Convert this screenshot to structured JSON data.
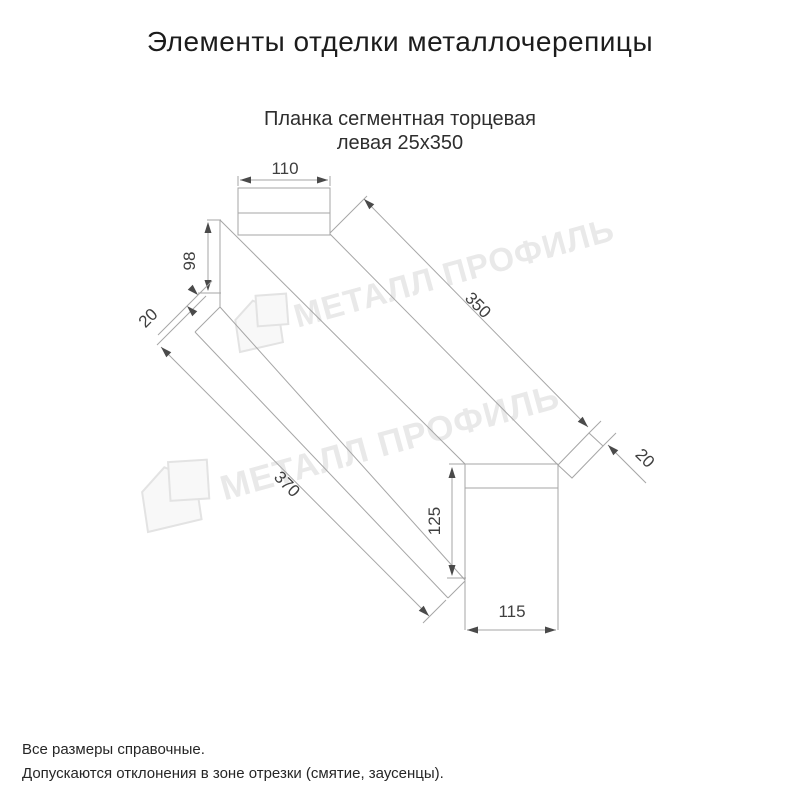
{
  "title": "Элементы отделки металлочерепицы",
  "product": {
    "line1": "Планка сегментная торцевая",
    "line2": "левая 25х350"
  },
  "dimensions": {
    "top_width": "110",
    "left_height": "98",
    "left_flap": "20",
    "top_length": "350",
    "right_flap": "20",
    "right_height": "125",
    "bottom_width": "115",
    "bottom_length": "370"
  },
  "watermark": {
    "brand": "МЕТАЛЛ ПРОФИЛЬ"
  },
  "notes": {
    "line1": "Все размеры справочные.",
    "line2": "Допускаются отклонения в зоне отрезки (смятие, заусенцы)."
  },
  "colors": {
    "line": "#a6a6a6",
    "dim_text": "#3f3f3f",
    "title_text": "#1c1c1c",
    "watermark": "#e9e9e9"
  }
}
